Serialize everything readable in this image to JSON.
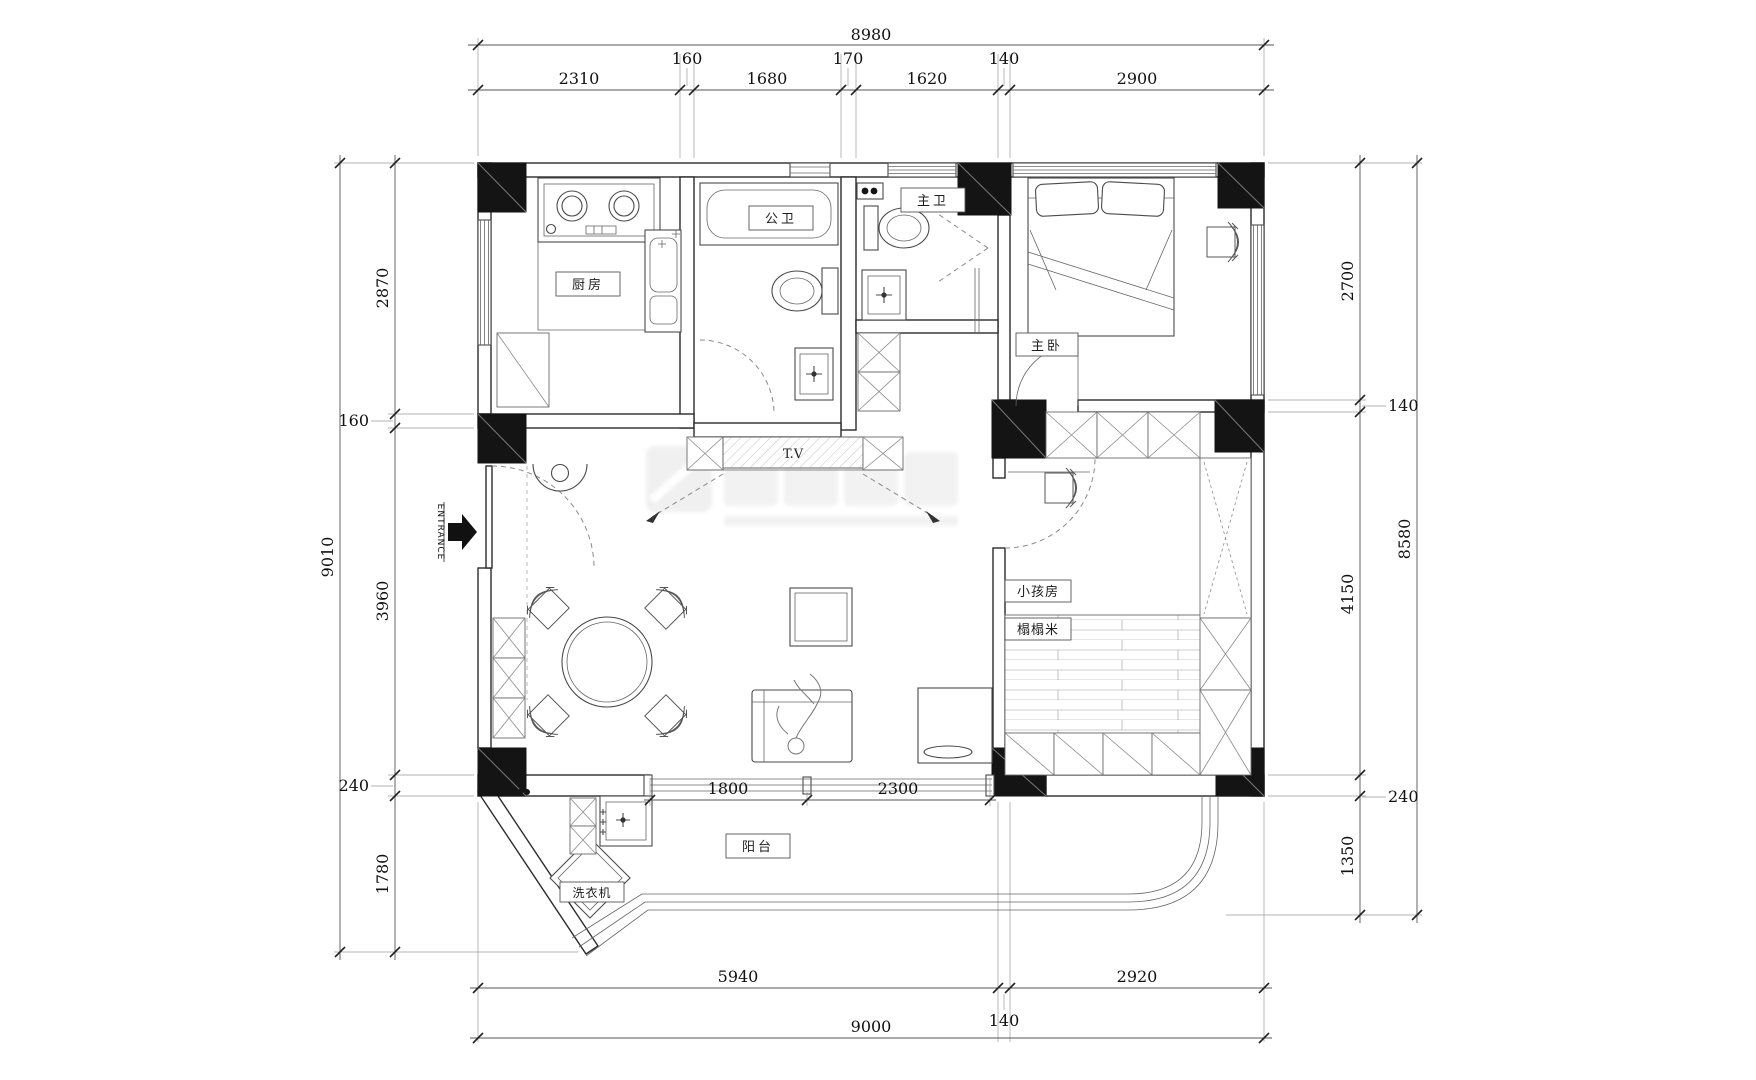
{
  "dims": {
    "top": {
      "overall": "8980",
      "segments": [
        "2310",
        "160",
        "1680",
        "170",
        "1620",
        "140",
        "2900"
      ]
    },
    "left": {
      "overall": "9010",
      "segments": [
        "2870",
        "160",
        "3960",
        "240",
        "1780"
      ]
    },
    "right": {
      "overall": "8580",
      "segments": [
        "2700",
        "140",
        "4150",
        "240",
        "1350"
      ]
    },
    "bottom": {
      "overall": "9000",
      "segments": [
        "5940",
        "140",
        "2920"
      ]
    },
    "balcony": {
      "segments": [
        "1800",
        "2300"
      ]
    }
  },
  "rooms": {
    "kitchen": "厨房",
    "public_bath": "公卫",
    "master_bath": "主卫",
    "master_bedroom": "主卧",
    "kids_room": "小孩房",
    "tatami": "榻榻米",
    "balcony": "阳台",
    "washer": "洗衣机"
  },
  "labels": {
    "tv": "T.V",
    "entrance": "ENTRANCE"
  },
  "colors": {
    "wall_fill": "#141414",
    "line": "#2b2b2b",
    "paper": "#ffffff"
  }
}
